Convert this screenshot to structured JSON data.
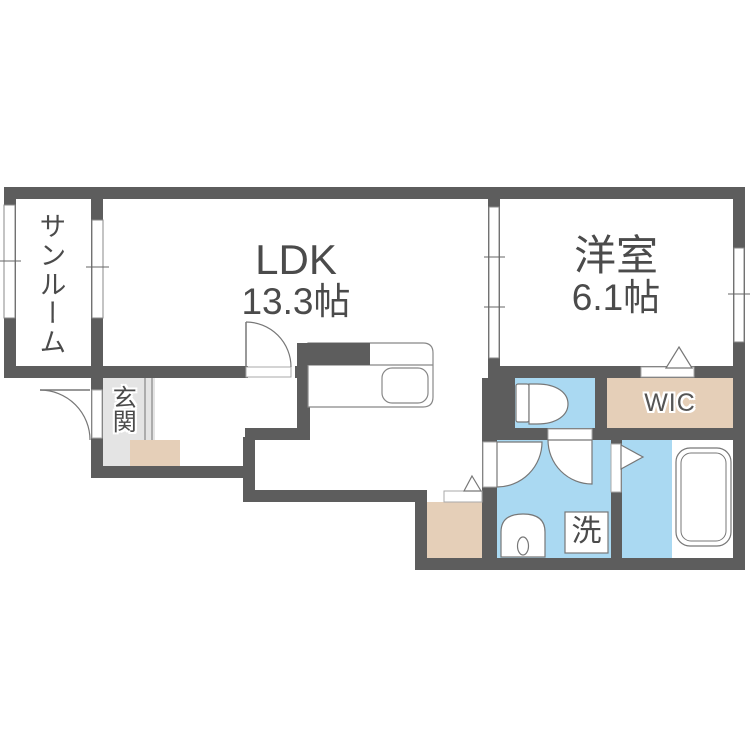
{
  "floorplan": {
    "rooms": [
      {
        "name": "sunroom",
        "label": "サンルーム"
      },
      {
        "name": "ldk",
        "label": "LDK",
        "area": "13.3帖"
      },
      {
        "name": "western-room",
        "label": "洋室",
        "area": "6.1帖"
      },
      {
        "name": "entrance",
        "label": "玄関"
      },
      {
        "name": "walk-in-closet",
        "label": "WIC"
      },
      {
        "name": "laundry",
        "label": "洗"
      }
    ],
    "palette": {
      "wall": "#5d5d5d",
      "wet_area_blue": "#aad9f2",
      "storage_beige": "#e5cfb8",
      "entrance_gray": "#e4e4e4",
      "fixture_line": "#777777",
      "text": "#4b4b4b"
    },
    "icons": [
      "toilet-icon",
      "bathtub-icon",
      "washbasin-icon",
      "washing-machine-icon",
      "kitchen-counter-icon",
      "kitchen-sink-icon",
      "door-swing-icon",
      "door-triangle-icon",
      "window-icon"
    ]
  }
}
